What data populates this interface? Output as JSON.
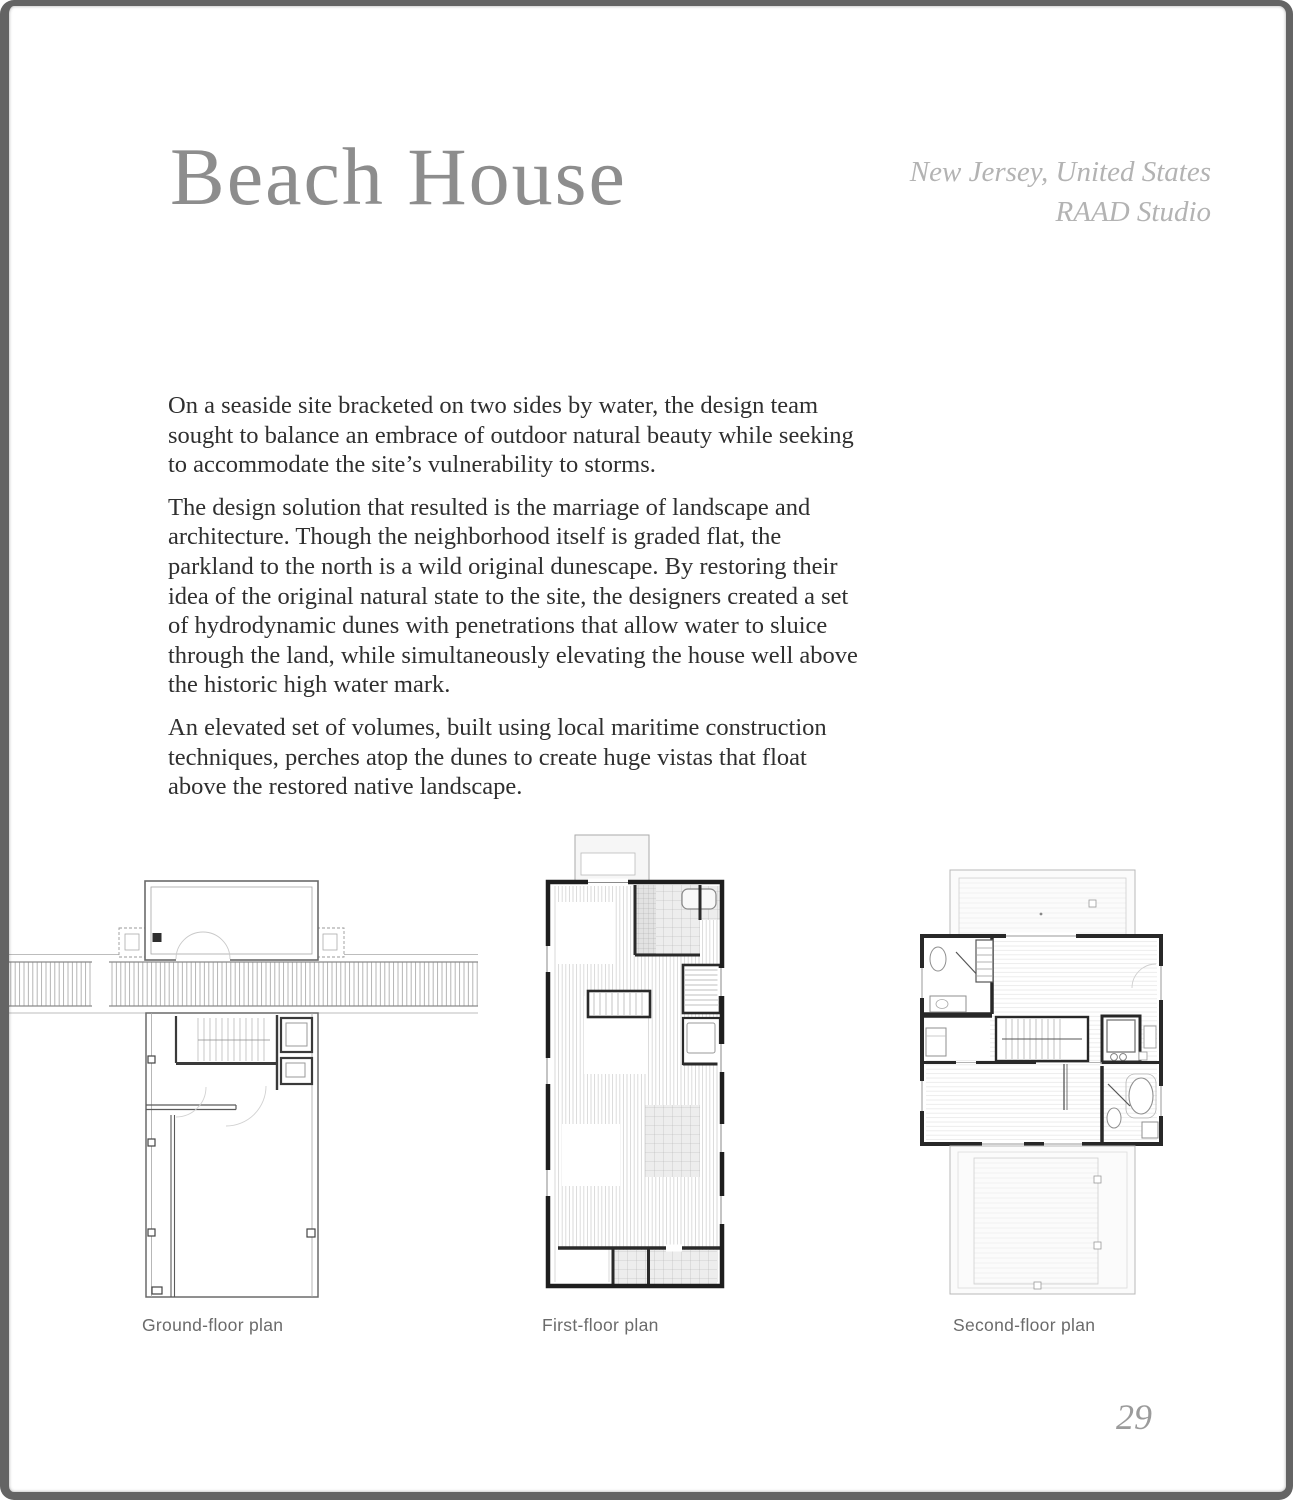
{
  "page": {
    "title": "Beach House",
    "location": {
      "line1": "New Jersey, United States",
      "line2": "RAAD Studio"
    },
    "page_number": "29",
    "colors": {
      "title": "#8d8d8d",
      "location": "#b3b3b3",
      "body_text": "#2f2f2f",
      "caption": "#6b6b6b",
      "frame": "#646464"
    }
  },
  "body": {
    "paragraphs": [
      {
        "lines": [
          "On a seaside site bracketed on two sides by water, the design team",
          "sought to balance an embrace of outdoor natural beauty while seeking",
          "to accommodate the site’s vulnerability to storms."
        ]
      },
      {
        "lines": [
          "The design solution that resulted is the marriage of landscape and",
          "architecture. Though the neighborhood itself is graded flat, the",
          "parkland to the north is a wild original dunescape. By restoring their",
          "idea of the original natural state to the site, the designers created a set",
          "of hydrodynamic dunes with penetrations that allow water to sluice",
          "through the land, while simultaneously elevating the house well above",
          "the historic high water mark."
        ]
      },
      {
        "lines": [
          "An elevated set of volumes, built using local maritime construction",
          "techniques, perches atop the dunes to create huge vistas that float",
          "above the restored native landscape."
        ]
      }
    ]
  },
  "figures": [
    {
      "caption": "Ground-floor plan"
    },
    {
      "caption": "First-floor plan"
    },
    {
      "caption": "Second-floor plan"
    }
  ]
}
